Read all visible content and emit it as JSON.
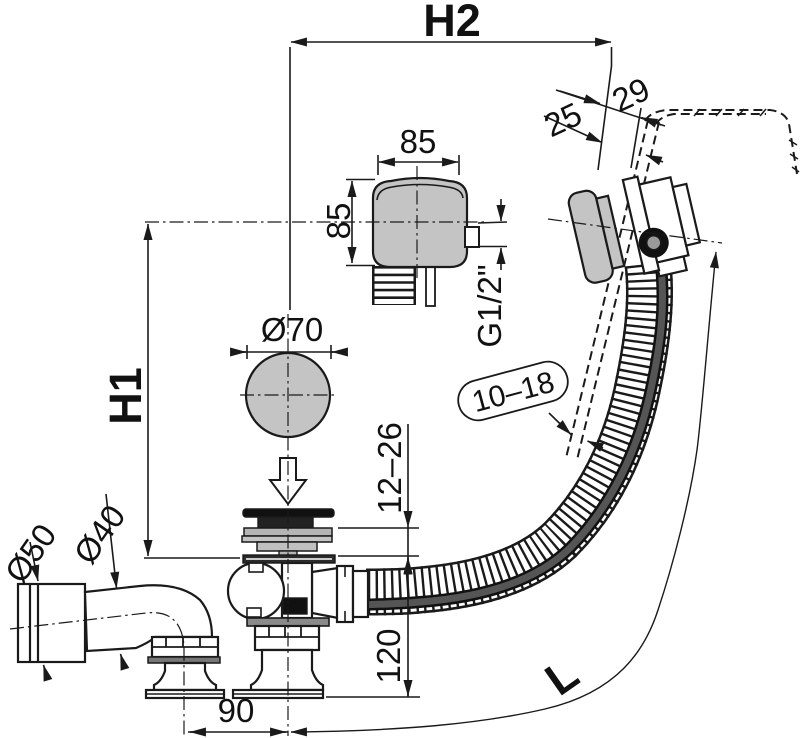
{
  "drawing": {
    "labels": {
      "h2": "H2",
      "h1": "H1",
      "length": "L",
      "width_85": "85",
      "height_85": "85",
      "rim_29": "29",
      "rim_25": "25",
      "knob_d70": "Ø70",
      "thread_g12": "G1/2\"",
      "wall_10_18": "10–18",
      "adjust_12_26": "12–26",
      "height_120": "120",
      "offset_90": "90",
      "pipe_d50": "Ø50",
      "pipe_d40": "Ø40"
    },
    "colors": {
      "line": "#1a1a1a",
      "part_gray": "#c4c4c4",
      "dark_part": "#222222",
      "cable_gray": "#555555",
      "background": "#ffffff"
    }
  }
}
